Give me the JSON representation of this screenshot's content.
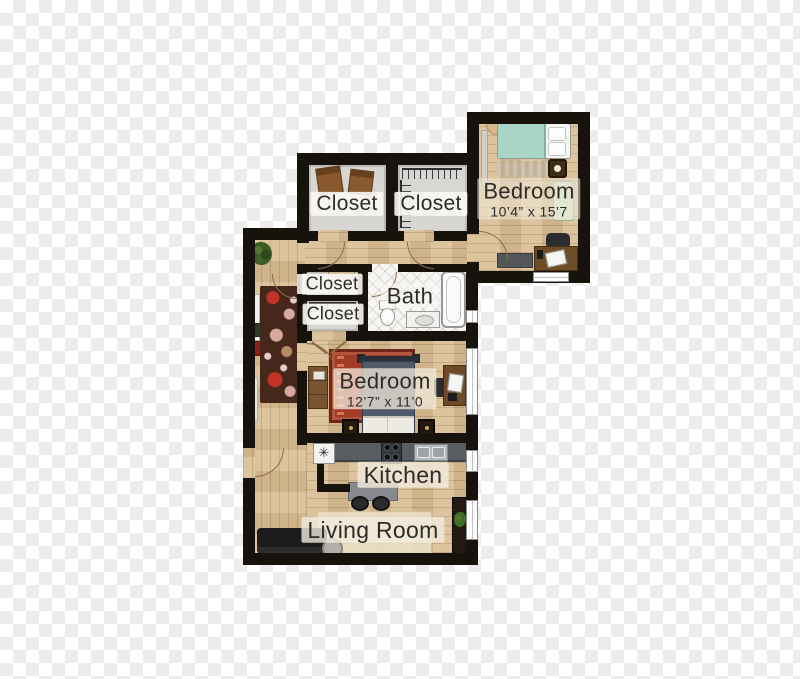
{
  "background": {
    "style": "transparency-checkerboard",
    "square_px": 13,
    "light": "#ffffff",
    "dark": "#ececec"
  },
  "palette": {
    "wall": "#18120d",
    "wood_floor": "#d8bd94",
    "closet_floor": "#d8d6d3",
    "bath_tile": "#f7f6f3",
    "label_text": "#2e2c29",
    "label_bg": "#f2ebdc",
    "bed_teal": "#a9d6c6",
    "bed_navy": "#4f5a6a",
    "rug_red": "#a23a28",
    "runner_brown": "#45281b",
    "counter_gray": "#595d61",
    "sofa_black": "#1c1c1c"
  },
  "rooms": {
    "closet_top_left": {
      "label": "Closet"
    },
    "closet_top_right": {
      "label": "Closet"
    },
    "bedroom_top": {
      "label": "Bedroom",
      "dimensions": "10’4” x 15’7"
    },
    "closet_mid_top": {
      "label": "Closet"
    },
    "closet_mid_bottom": {
      "label": "Closet"
    },
    "bath": {
      "label": "Bath"
    },
    "bedroom_main": {
      "label": "Bedroom",
      "dimensions": "12’7” x 11’0"
    },
    "kitchen": {
      "label": "Kitchen"
    },
    "living_room": {
      "label": "Living Room"
    }
  },
  "icons": {
    "appliance_glyph": "✳"
  }
}
